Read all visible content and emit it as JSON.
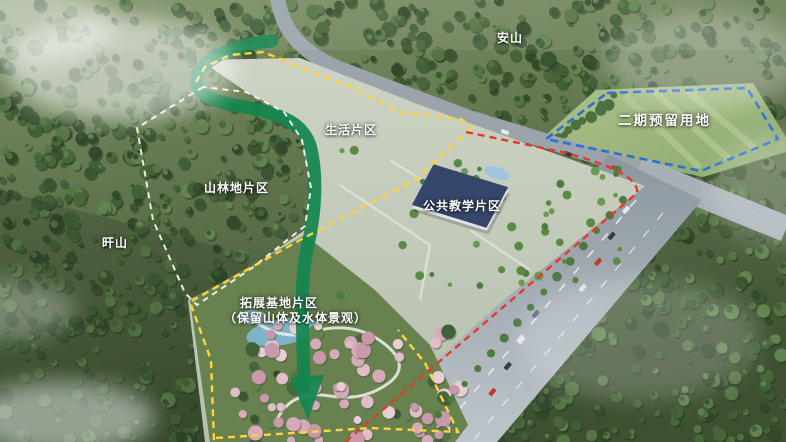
{
  "labels": {
    "an_mountain": "安山",
    "phase2_reserved": "二期预留用地",
    "living_area": "生活片区",
    "forest_area": "山林地片区",
    "gan_mountain": "旰山",
    "teaching_area": "公共教学片区",
    "expansion_line1": "拓展基地片区",
    "expansion_line2": "（保留山体及水体景观）"
  },
  "colors": {
    "phase2_boundary": "#2e6fd8",
    "site_boundary_red": "#e6392b",
    "zone_boundary_yellow": "#ffd23e",
    "forest_boundary_white": "#f5f3ec",
    "green_axis": "#12854f",
    "green_axis_dark": "#0d6b3e"
  }
}
